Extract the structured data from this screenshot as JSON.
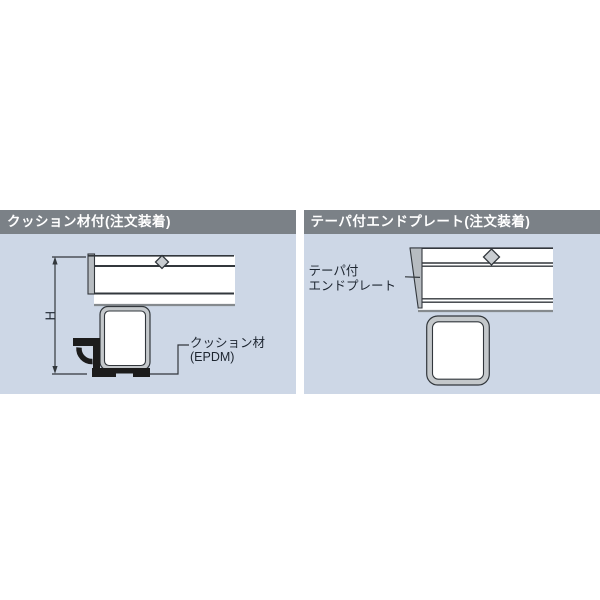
{
  "panels": {
    "cushion": {
      "title": "クッション材付(注文装着)",
      "dimension_label": "H",
      "callout": {
        "line1": "クッション材",
        "line2": "(EPDM)"
      }
    },
    "taper": {
      "title": "テーパ付エンドプレート(注文装着)",
      "callout": {
        "line1": "テーパ付",
        "line2": "エンドプレート"
      }
    }
  },
  "colors": {
    "panel_bg": "#cdd7e6",
    "header_bg": "#7b8187",
    "header_text": "#ffffff",
    "line": "#32373c",
    "soft_line": "#858a8e",
    "metal_fill": "#b7bcc1",
    "diamond_fill": "#c9cdd1",
    "tube_ring": "#c4c8cb",
    "drawing_white": "#ffffff",
    "cushion_black": "#1c1c1c",
    "label_text": "#1d2530"
  }
}
